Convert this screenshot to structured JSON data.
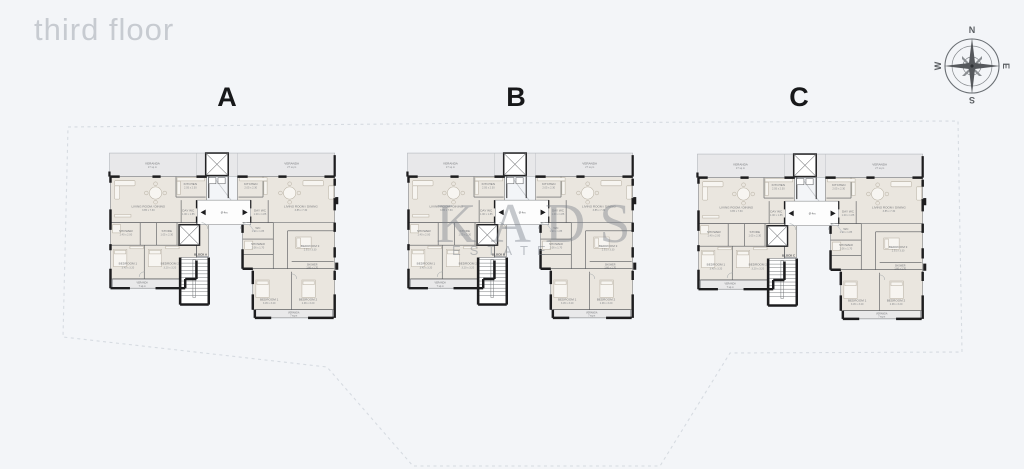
{
  "page": {
    "title": "third floor"
  },
  "colors": {
    "background": "#f3f5f8",
    "wall": "#1d1d1f",
    "room_fill": "#eae6df",
    "veranda_fill": "#e8e8ea",
    "boundary_line": "#d6dbe1",
    "watermark": "#7a7e87",
    "compass_north_red": "#b3392f",
    "title_gray": "#c7cbd1"
  },
  "watermark": {
    "brand": "KADS",
    "subtitle": "ESTATE"
  },
  "compass": {
    "north": "N",
    "east": "E",
    "south": "S",
    "west": "W"
  },
  "plans": [
    {
      "label": "A",
      "block_label": "BLOCK A"
    },
    {
      "label": "B",
      "block_label": "BLOCK B"
    },
    {
      "label": "C",
      "block_label": "BLOCK C"
    }
  ],
  "plan_rooms": {
    "veranda_top_left": {
      "name": "VERANDA",
      "dim": "27 sq.m"
    },
    "veranda_top_right": {
      "name": "VERANDA",
      "dim": "27 sq.m"
    },
    "living_left": {
      "name": "LIVING ROOM / DINING",
      "dim": "3.85 x 7.30"
    },
    "living_right": {
      "name": "LIVING ROOM / DINING",
      "dim": "3.85 x 7.30"
    },
    "kitchen_left": {
      "name": "KITCHEN",
      "dim": "2.05 x 2.30"
    },
    "kitchen_right": {
      "name": "KITCHEN",
      "dim": "2.05 x 2.30"
    },
    "day_wc_left": {
      "name": "DAY WC",
      "dim": "1.00 x 1.85"
    },
    "day_wc_right": {
      "name": "DAY WC",
      "dim": "1.00 x 1.85"
    },
    "lobby": {
      "name": "Ø 4m"
    },
    "shower_left": {
      "name": "SHOWER",
      "dim": "1.40 x 2.00"
    },
    "store_left": {
      "name": "STORE",
      "dim": "1.05 x 2.30"
    },
    "bedroom1_left": {
      "name": "BEDROOM 1",
      "dim": "3.45 x 3.20"
    },
    "bedroom2_left": {
      "name": "BEDROOM 2",
      "dim": "3.20 x 3.20"
    },
    "veranda_bottom_left": {
      "name": "VERANDA",
      "dim": "7 sq.m"
    },
    "wc_right": {
      "name": "WC",
      "dim": "1.10 x 1.85"
    },
    "shower_right": {
      "name": "SHOWER",
      "dim": "2.06 x 1.70"
    },
    "bedroom3_right": {
      "name": "BEDROOM 3",
      "dim": "2.91 x 3.30"
    },
    "shower2_right": {
      "name": "SHOWER",
      "dim": "1.66 x 1.70"
    },
    "bedroom1_right": {
      "name": "BEDROOM 1",
      "dim": "3.45 x 3.20"
    },
    "bedroom2_right": {
      "name": "BEDROOM 2",
      "dim": "2.96 x 3.20"
    },
    "veranda_bottom_right": {
      "name": "VERANDA",
      "dim": "7 sq.m"
    }
  }
}
